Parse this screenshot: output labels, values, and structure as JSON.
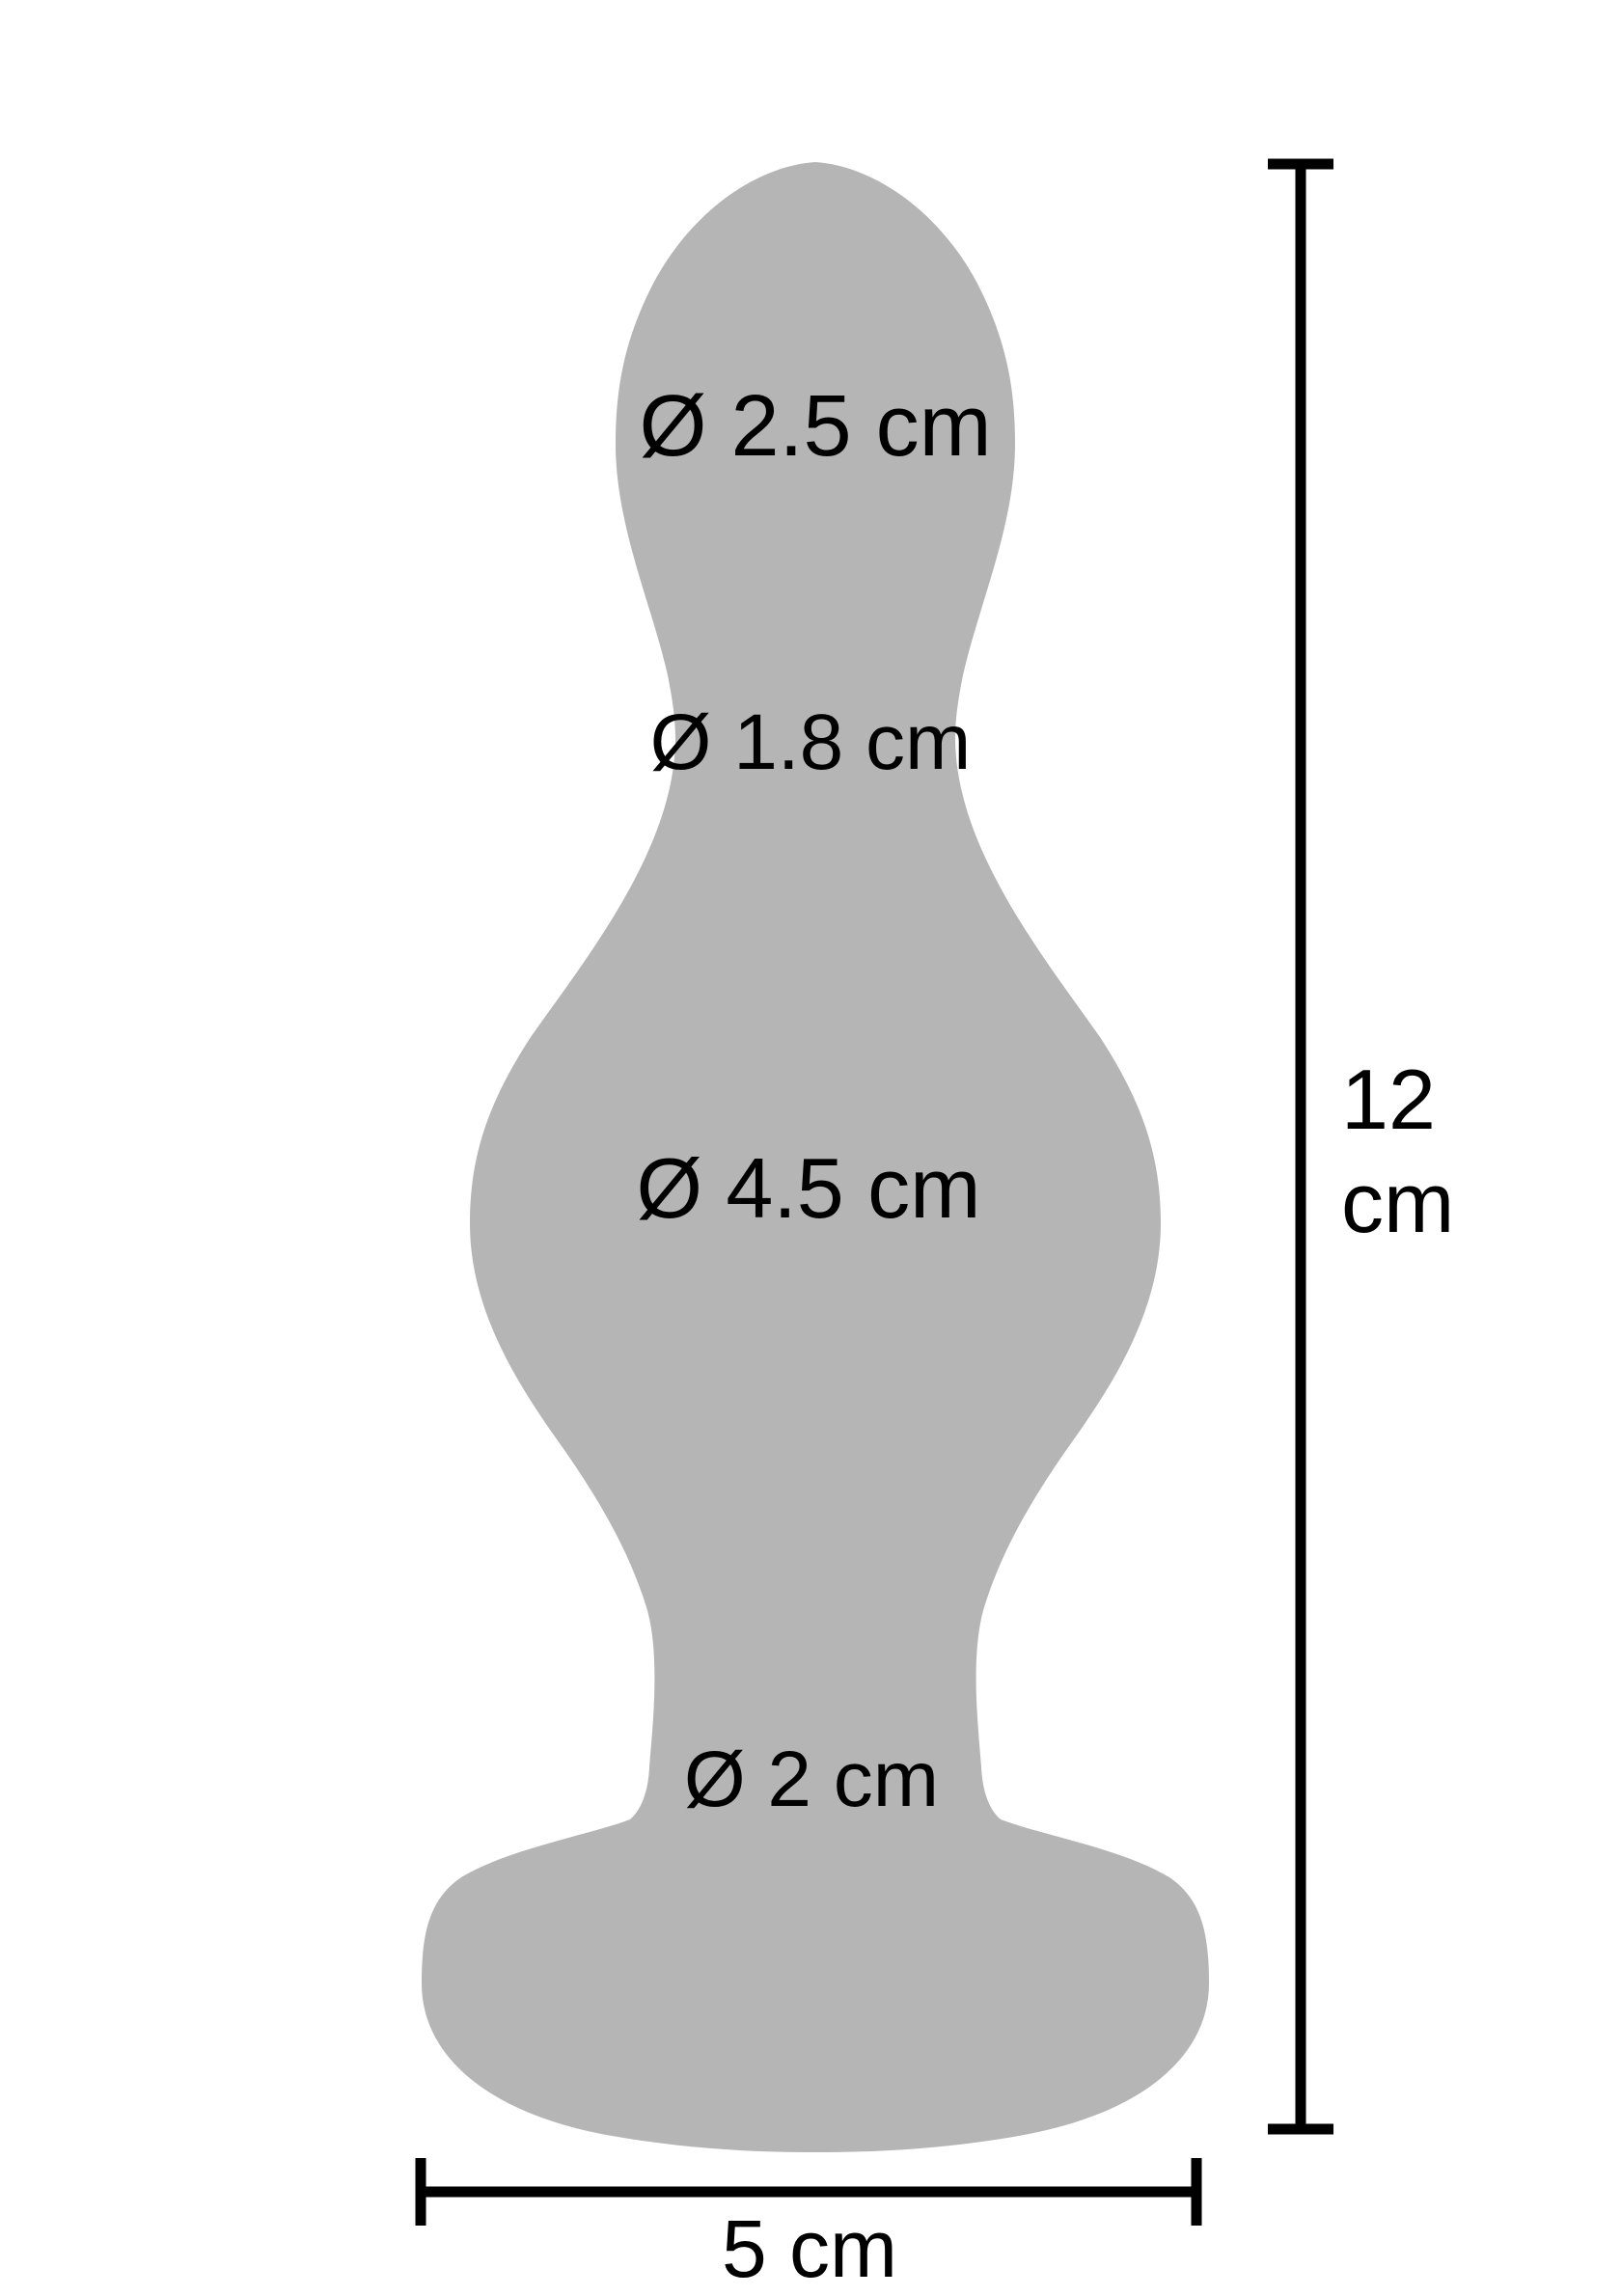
{
  "page": {
    "background": "#ffffff"
  },
  "diagram": {
    "type": "product-dimension-diagram",
    "silhouette_color": "#b5b5b5",
    "dimension_color": "#000000",
    "labels": {
      "head_diameter": "Ø 2.5 cm",
      "neck_diameter": "Ø 1.8 cm",
      "body_diameter": "Ø 4.5 cm",
      "stem_diameter": "Ø 2 cm",
      "total_height_value": "12",
      "total_height_unit": "cm",
      "base_width": "5 cm"
    }
  }
}
